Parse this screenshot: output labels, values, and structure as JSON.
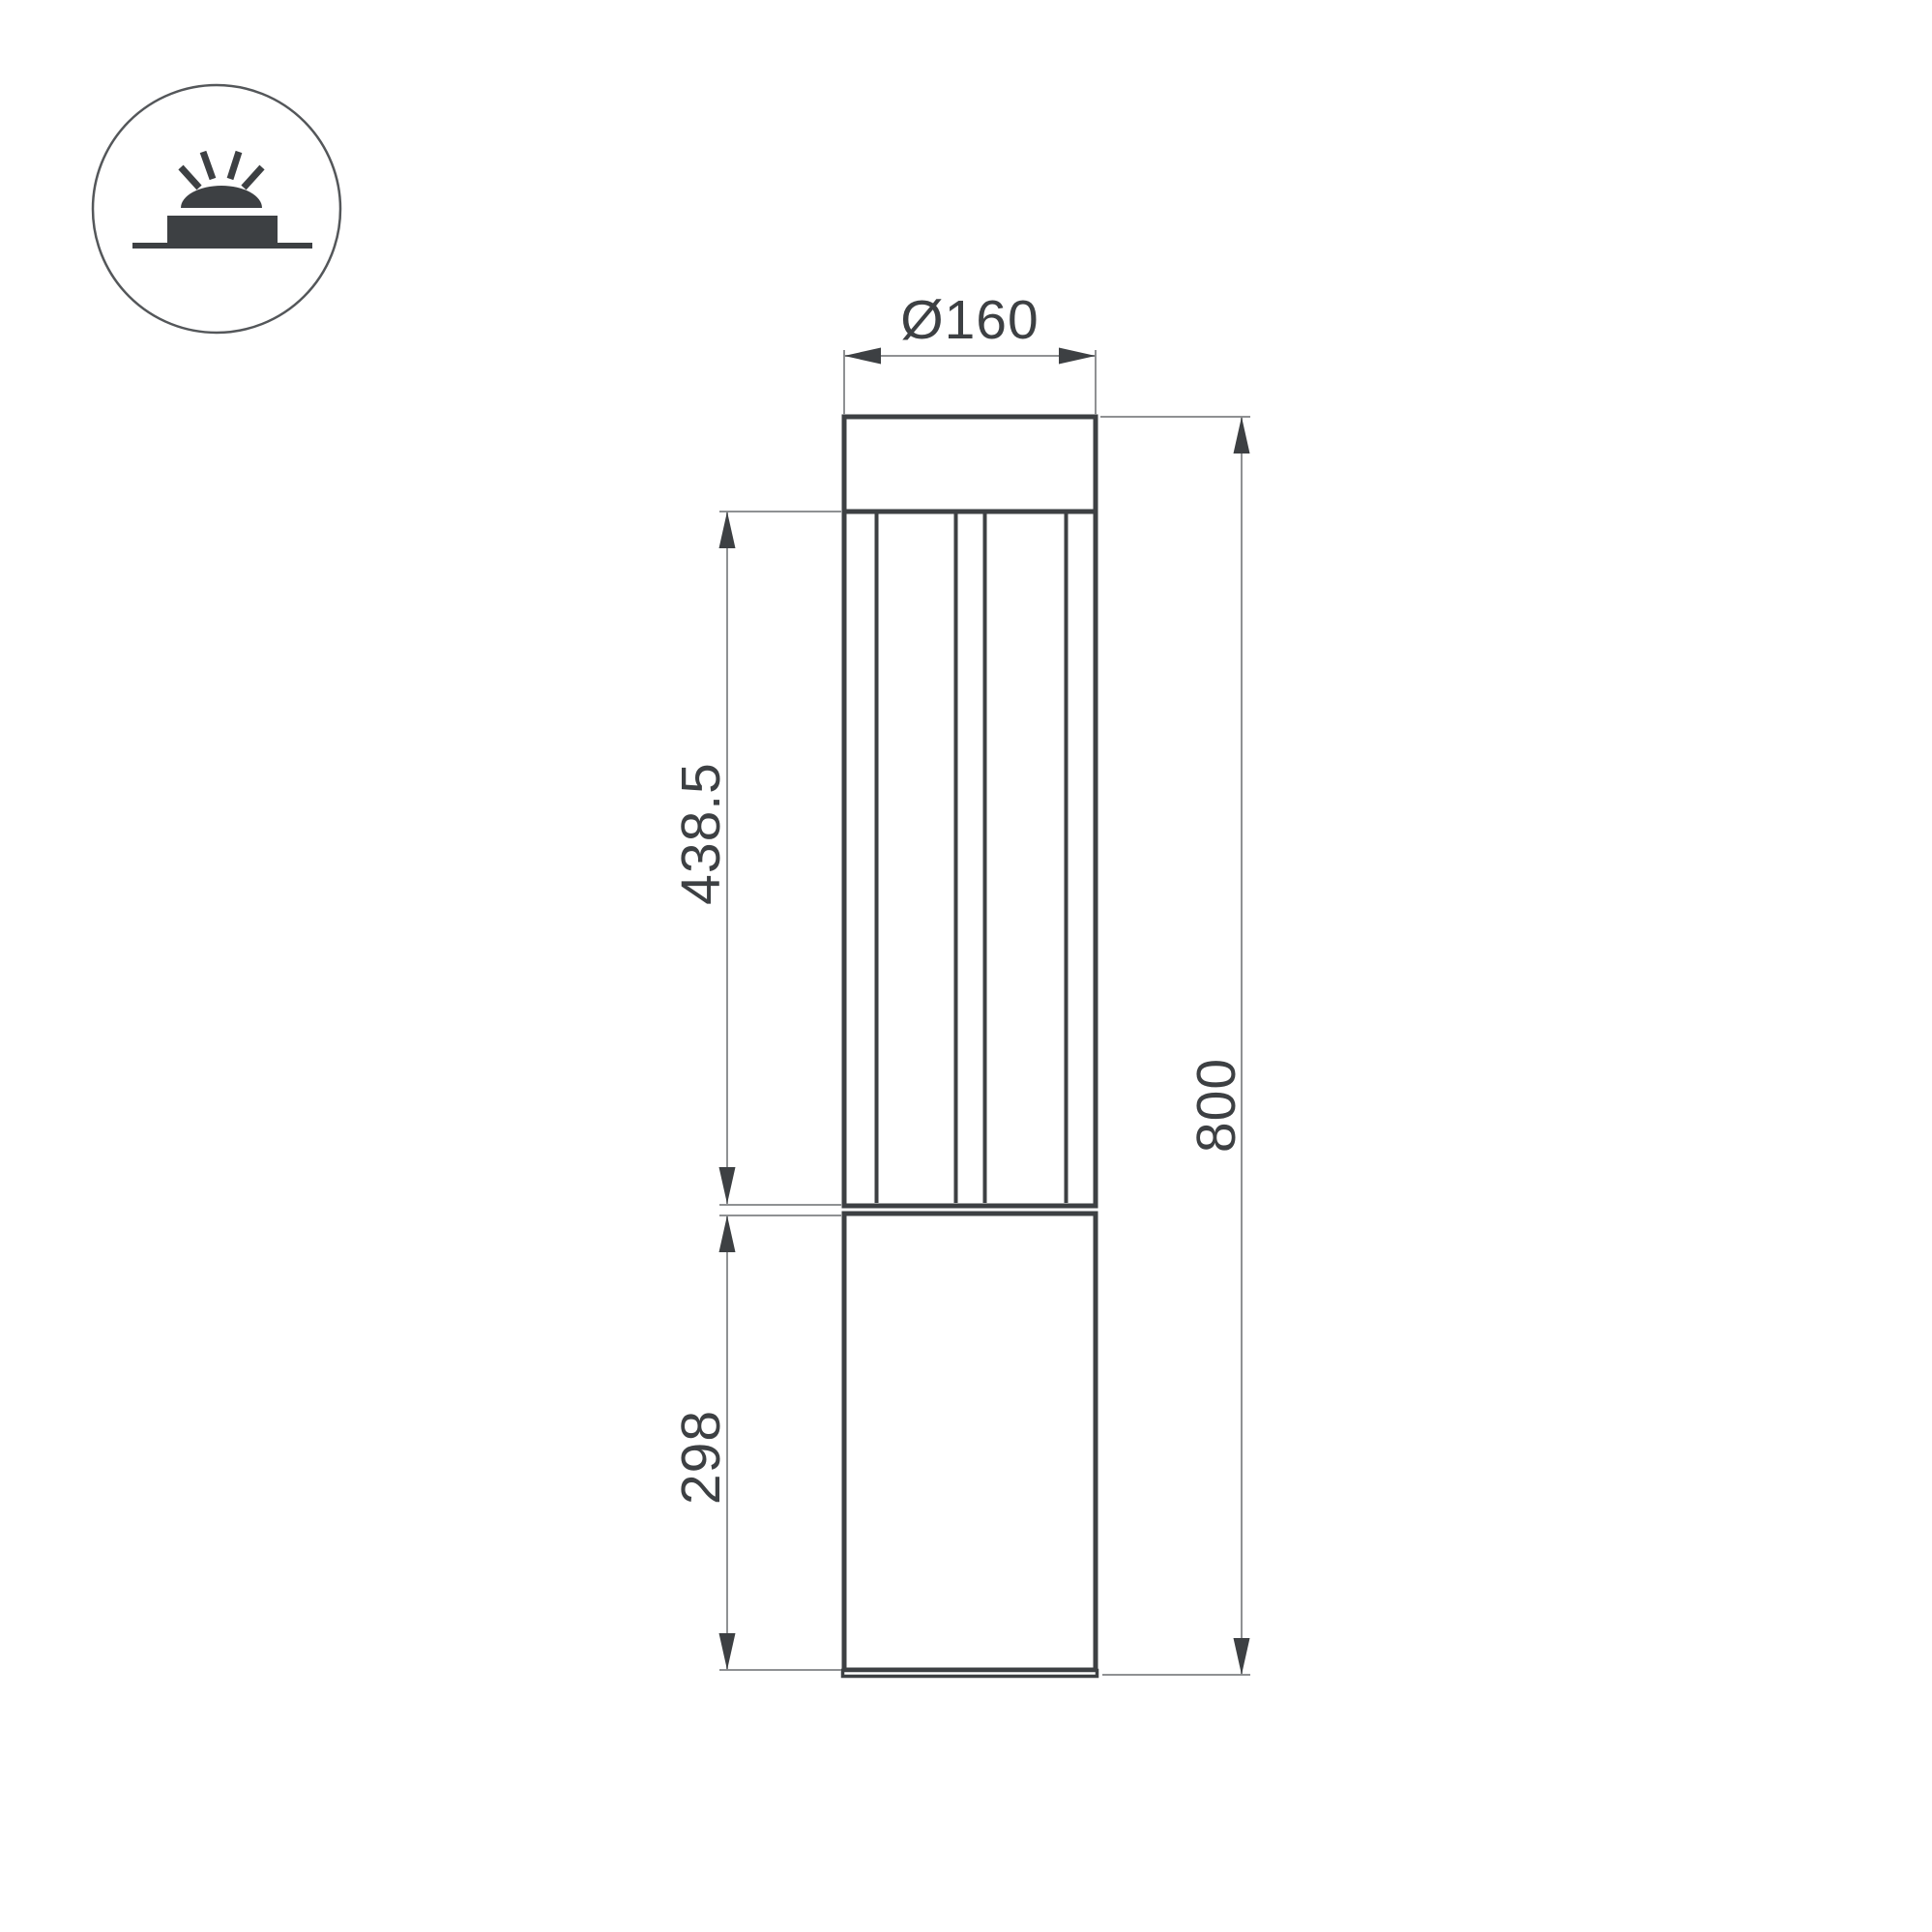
{
  "page": {
    "background": "#ffffff",
    "type_label": "bollard-light-dimension-drawing"
  },
  "colors": {
    "outline": "#3d4043",
    "icon_circle": "#54575a",
    "thin_line": "#8f9193",
    "label_text": "#3d4043"
  },
  "icon": {
    "name": "ground-mounted-light-symbol"
  },
  "dimensions": {
    "diameter_label": "Ø160",
    "lamp_height_label": "438.5",
    "base_height_label": "298",
    "total_height_label": "800"
  }
}
